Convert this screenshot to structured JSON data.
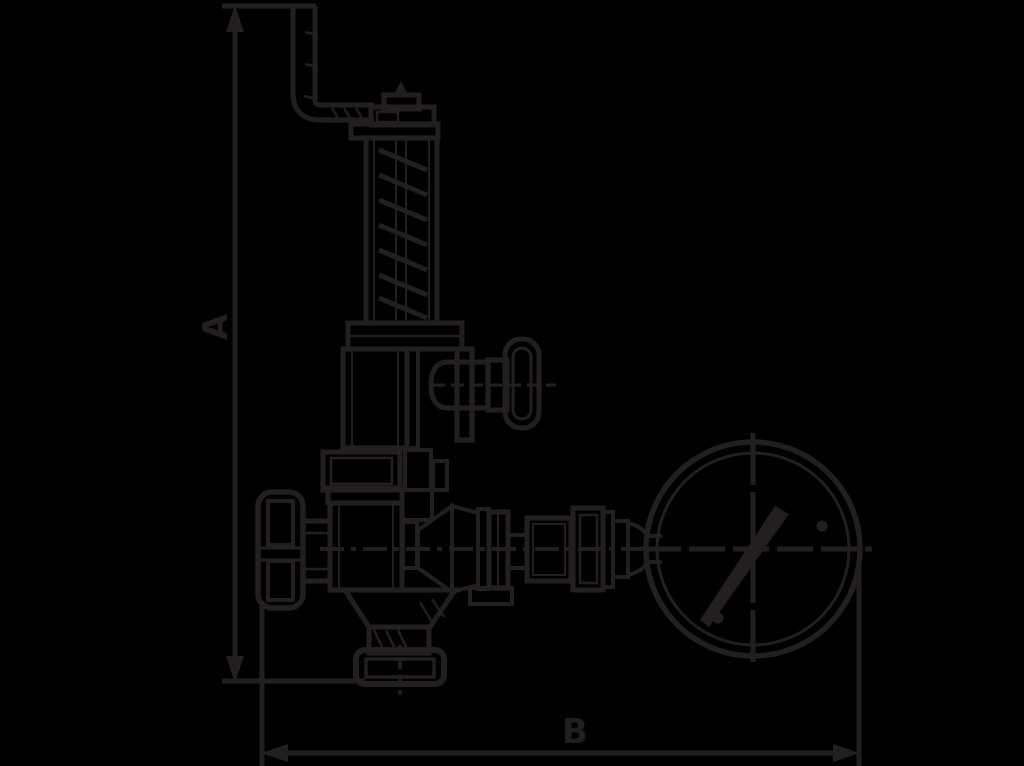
{
  "page": {
    "background_color": "#000000",
    "ink_color": "#231f20"
  },
  "diagram": {
    "type": "technical-drawing",
    "description": "Outline drawing of a safety relief valve with bent lever arm, spring bonnet, test knob, handwheel, outlet train and pressure gauge, with overall dimensions marked",
    "dimensions": {
      "a": "A",
      "b": "B"
    },
    "components": [
      "lever-arm",
      "adjusting-cap",
      "spring-bonnet",
      "test-knob",
      "handwheel",
      "valve-body",
      "outlet-assembly",
      "pressure-gauge",
      "inlet-connection"
    ]
  }
}
